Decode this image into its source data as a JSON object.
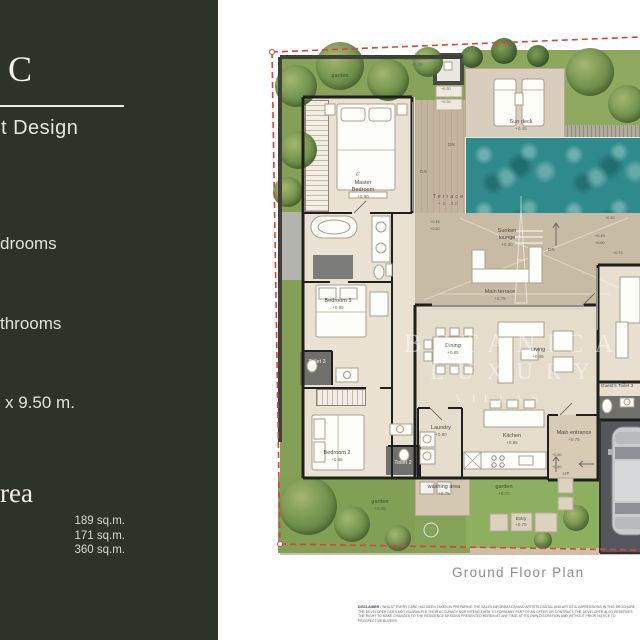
{
  "colors": {
    "sidebar_bg": "#2d3427",
    "boundary_red": "#df4338",
    "pool_water": "#2f8a8c",
    "grass": "#8aa55c",
    "wall": "#1f1f1d"
  },
  "sidebar": {
    "type_letter": "C",
    "design_line": "t Design",
    "feature_bedrooms": "drooms",
    "feature_bathrooms": "throoms",
    "dimensions": "x 9.50 m.",
    "area_heading": "rea",
    "area_values": [
      "189 sq.m.",
      "171 sq.m.",
      "360 sq.m."
    ]
  },
  "plan": {
    "caption": "Ground Floor Plan",
    "watermark": {
      "line1": "BOTANICA",
      "line2": "LUXURY",
      "line3": "VILLAS"
    },
    "rooms": {
      "outdoor_shower": {
        "name": "Outdoor shower",
        "level": "+0.30"
      },
      "garden_top": {
        "name": "garden",
        "level": ""
      },
      "sun_deck": {
        "name": "Sun deck",
        "level": "+0.45"
      },
      "master_bedroom": {
        "name": "Master Bedroom",
        "level": "+0.90"
      },
      "terrace": {
        "name": "Terrace",
        "level": "+0.30"
      },
      "sunken_lounge": {
        "name": "Sunken lounge",
        "level": "+0.30"
      },
      "main_terrace": {
        "name": "Main terrace",
        "level": "+0.75"
      },
      "bedroom_3": {
        "name": "Bedroom 3",
        "level": "+0.85"
      },
      "toilet_3": {
        "name": "Toilet 3",
        "level": ""
      },
      "bedroom_2": {
        "name": "Bedroom 2",
        "level": "+0.85"
      },
      "toilet_2": {
        "name": "Toilet 2",
        "level": ""
      },
      "laundry": {
        "name": "Laundry",
        "level": "+0.80"
      },
      "kitchen": {
        "name": "Kitchen",
        "level": "+0.85"
      },
      "dining": {
        "name": "Dining",
        "level": "+0.85"
      },
      "living": {
        "name": "Living",
        "level": "+0.85"
      },
      "main_entrance": {
        "name": "Main entrance",
        "level": "+0.75"
      },
      "guest_toilet": {
        "name": "Guest's Toilet 3",
        "level": ""
      },
      "washing_area": {
        "name": "washing area",
        "level": "+0.75"
      },
      "garden_inner": {
        "name": "garden",
        "level": "+0.70"
      },
      "garden_bottom": {
        "name": "garden",
        "level": "+0.45"
      },
      "entry": {
        "name": "Entry",
        "level": "+0.75"
      }
    },
    "markers": {
      "dn": "DN",
      "up": "UP",
      "bed_size": "6'",
      "levels": [
        "+0.45",
        "+0.60",
        "+0.45",
        "+0.60",
        "+0.30",
        "+0.75",
        "+0.30",
        "+0.30",
        "+0.60",
        "+0.40"
      ]
    }
  },
  "disclaimer": {
    "heading": "DISCLAIMER :",
    "body": "WHILST EVERY CARE HAS BEEN TAKEN IN PREPARING THE SALES INFORMATION AND ARTISTS DIGITAL AND ARTISTIC IMPRESSIONS IN THIS BROCHURE, THE DEVELOPER DOES NOT GUARANTEE THEIR ACCURACY NOR INTEND THEM TO FORM ANY PART OF AN OFFER OR CONTRACT. THE DEVELOPER ALSO RESERVES THE RIGHT TO MAKE CHANGES TO THE RESIDENCE DESIGNS PRESENTED HEREIN AT ANY TIME, AT ITS OWN DISCRETION AND WITHOUT PRIOR NOTICE TO PROSPECTIVE BUYERS."
  }
}
